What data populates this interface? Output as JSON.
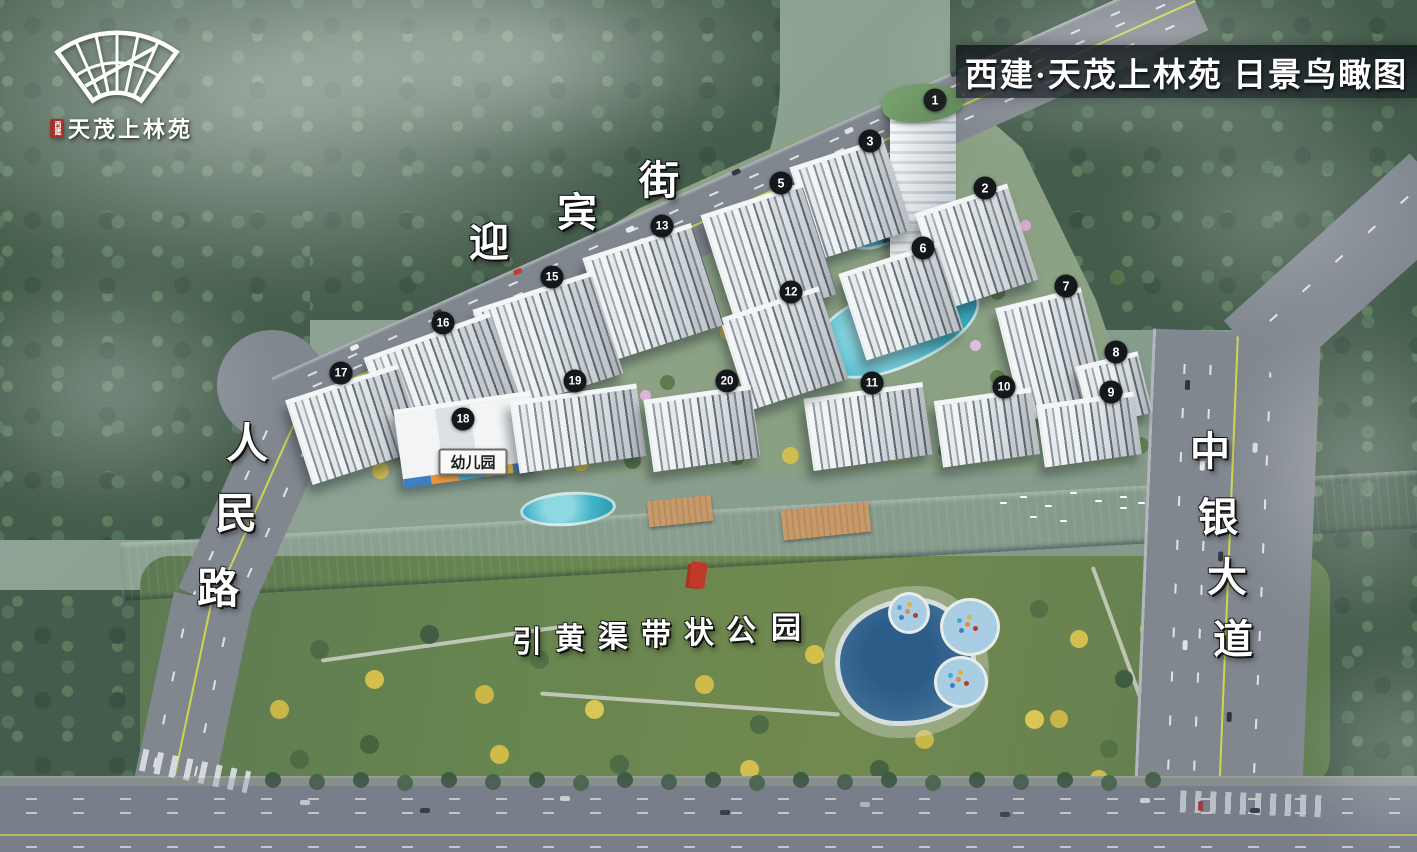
{
  "banner": {
    "title": "西建·天茂上林苑 日景鸟瞰图"
  },
  "logo": {
    "name": "天茂上林苑",
    "seal": "西建"
  },
  "road_labels": [
    {
      "id": "yingbin-street",
      "text": "迎宾街",
      "size": 40,
      "chars": [
        {
          "c": "迎",
          "x": 489,
          "y": 243
        },
        {
          "c": "宾",
          "x": 577,
          "y": 213
        },
        {
          "c": "街",
          "x": 659,
          "y": 181
        }
      ]
    },
    {
      "id": "renmin-road",
      "text": "人民路",
      "size": 42,
      "chars": [
        {
          "c": "人",
          "x": 247,
          "y": 445
        },
        {
          "c": "民",
          "x": 236,
          "y": 515
        },
        {
          "c": "路",
          "x": 218,
          "y": 590
        }
      ]
    },
    {
      "id": "zhongyin-avenue",
      "text": "中银大道",
      "size": 40,
      "chars": [
        {
          "c": "中",
          "x": 1210,
          "y": 452
        },
        {
          "c": "银",
          "x": 1218,
          "y": 518
        },
        {
          "c": "大",
          "x": 1227,
          "y": 578
        },
        {
          "c": "道",
          "x": 1233,
          "y": 640
        }
      ]
    },
    {
      "id": "park-label",
      "text": "引黄渠带状公园",
      "size": 30,
      "chars": [
        {
          "c": "引",
          "x": 527,
          "y": 643
        },
        {
          "c": "黄",
          "x": 570,
          "y": 640
        },
        {
          "c": "渠",
          "x": 613,
          "y": 638
        },
        {
          "c": "带",
          "x": 656,
          "y": 636
        },
        {
          "c": "状",
          "x": 699,
          "y": 634
        },
        {
          "c": "公",
          "x": 741,
          "y": 632
        },
        {
          "c": "园",
          "x": 786,
          "y": 629
        }
      ]
    }
  ],
  "kindergarten": {
    "label": "幼儿园",
    "x": 473,
    "y": 462
  },
  "buildings": [
    {
      "num": "1",
      "style": "tower",
      "rect": [
        890,
        104,
        66,
        162,
        0
      ],
      "badge": [
        935,
        100
      ]
    },
    {
      "num": "2",
      "style": "slab",
      "rect": [
        928,
        196,
        95,
        96,
        -18
      ],
      "badge": [
        985,
        188
      ]
    },
    {
      "num": "3",
      "style": "slab",
      "rect": [
        802,
        150,
        96,
        92,
        -18
      ],
      "badge": [
        870,
        141
      ]
    },
    {
      "num": "5",
      "style": "slab",
      "rect": [
        716,
        196,
        104,
        112,
        -18
      ],
      "badge": [
        781,
        183
      ]
    },
    {
      "num": "6",
      "style": "slab",
      "rect": [
        850,
        256,
        100,
        86,
        -18
      ],
      "badge": [
        923,
        248
      ]
    },
    {
      "num": "7",
      "style": "slab",
      "rect": [
        1008,
        296,
        86,
        112,
        -14
      ],
      "badge": [
        1066,
        286
      ]
    },
    {
      "num": "8",
      "style": "slab",
      "rect": [
        1082,
        358,
        62,
        58,
        -14
      ],
      "badge": [
        1116,
        352
      ]
    },
    {
      "num": "9",
      "style": "slab",
      "rect": [
        1040,
        398,
        96,
        58,
        -8
      ],
      "badge": [
        1111,
        392
      ]
    },
    {
      "num": "10",
      "style": "slab",
      "rect": [
        938,
        394,
        96,
        62,
        -8
      ],
      "badge": [
        1004,
        387
      ]
    },
    {
      "num": "11",
      "style": "slab",
      "rect": [
        808,
        390,
        118,
        68,
        -8
      ],
      "badge": [
        872,
        383
      ]
    },
    {
      "num": "12",
      "style": "slab",
      "rect": [
        732,
        300,
        102,
        92,
        -18
      ],
      "badge": [
        791,
        292
      ]
    },
    {
      "num": "13",
      "style": "slab",
      "rect": [
        596,
        238,
        112,
        102,
        -18
      ],
      "badge": [
        662,
        226
      ]
    },
    {
      "num": "15",
      "style": "slab",
      "rect": [
        486,
        288,
        122,
        102,
        -18
      ],
      "badge": [
        552,
        277
      ]
    },
    {
      "num": "16",
      "style": "slab",
      "rect": [
        376,
        332,
        132,
        92,
        -20
      ],
      "badge": [
        443,
        323
      ]
    },
    {
      "num": "17",
      "style": "slab",
      "rect": [
        296,
        380,
        116,
        84,
        -18
      ],
      "badge": [
        341,
        373
      ]
    },
    {
      "num": "18",
      "style": "kinder",
      "rect": [
        398,
        400,
        138,
        72,
        -8
      ],
      "badge": [
        463,
        419
      ]
    },
    {
      "num": "19",
      "style": "slab",
      "rect": [
        514,
        392,
        126,
        68,
        -8
      ],
      "badge": [
        575,
        381
      ]
    },
    {
      "num": "20",
      "style": "slab",
      "rect": [
        648,
        392,
        106,
        68,
        -8
      ],
      "badge": [
        727,
        381
      ]
    }
  ],
  "colors": {
    "banner_bg": "rgba(18,24,29,0.8)",
    "badge_bg": "#14181b",
    "river": "#54799f",
    "pool_cyan": "#41b3c6",
    "park_green": "#5e7b50",
    "forest_green": "#445c4b",
    "road_gray": "#81878f",
    "tower_roof_green": "#6d9a68",
    "seal_red": "#a5302a"
  }
}
